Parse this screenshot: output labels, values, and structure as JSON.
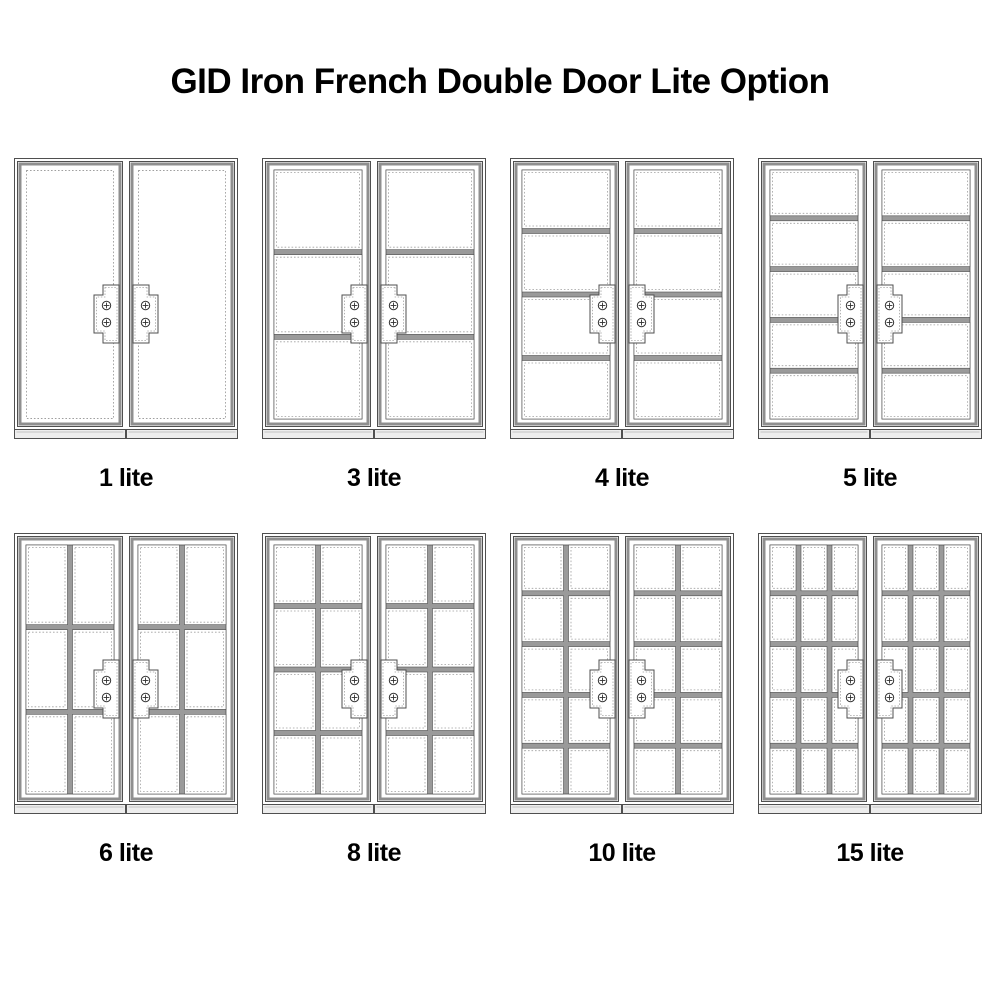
{
  "title": "GID Iron French Double Door Lite Option",
  "options": [
    {
      "label": "1 lite",
      "lites": 1,
      "cols": 1,
      "rows": 1
    },
    {
      "label": "3 lite",
      "lites": 3,
      "cols": 1,
      "rows": 3
    },
    {
      "label": "4 lite",
      "lites": 4,
      "cols": 1,
      "rows": 4
    },
    {
      "label": "5 lite",
      "lites": 5,
      "cols": 1,
      "rows": 5
    },
    {
      "label": "6 lite",
      "lites": 6,
      "cols": 2,
      "rows": 3
    },
    {
      "label": "8 lite",
      "lites": 8,
      "cols": 2,
      "rows": 4
    },
    {
      "label": "10 lite",
      "lites": 10,
      "cols": 2,
      "rows": 5
    },
    {
      "label": "15 lite",
      "lites": 15,
      "cols": 3,
      "rows": 5
    }
  ],
  "door_style": {
    "leaves_per_unit": 2,
    "screws_per_handle_plate": 2
  },
  "colors": {
    "background": "#ffffff",
    "text": "#000000",
    "outline": "#4f4f4f",
    "frame_band": "#8f8f8f",
    "muntin": "#9a9a9a",
    "dotted": "#a0a0a0",
    "sill_fill": "#ededed",
    "screw": "#333333",
    "glass": "#ffffff"
  }
}
